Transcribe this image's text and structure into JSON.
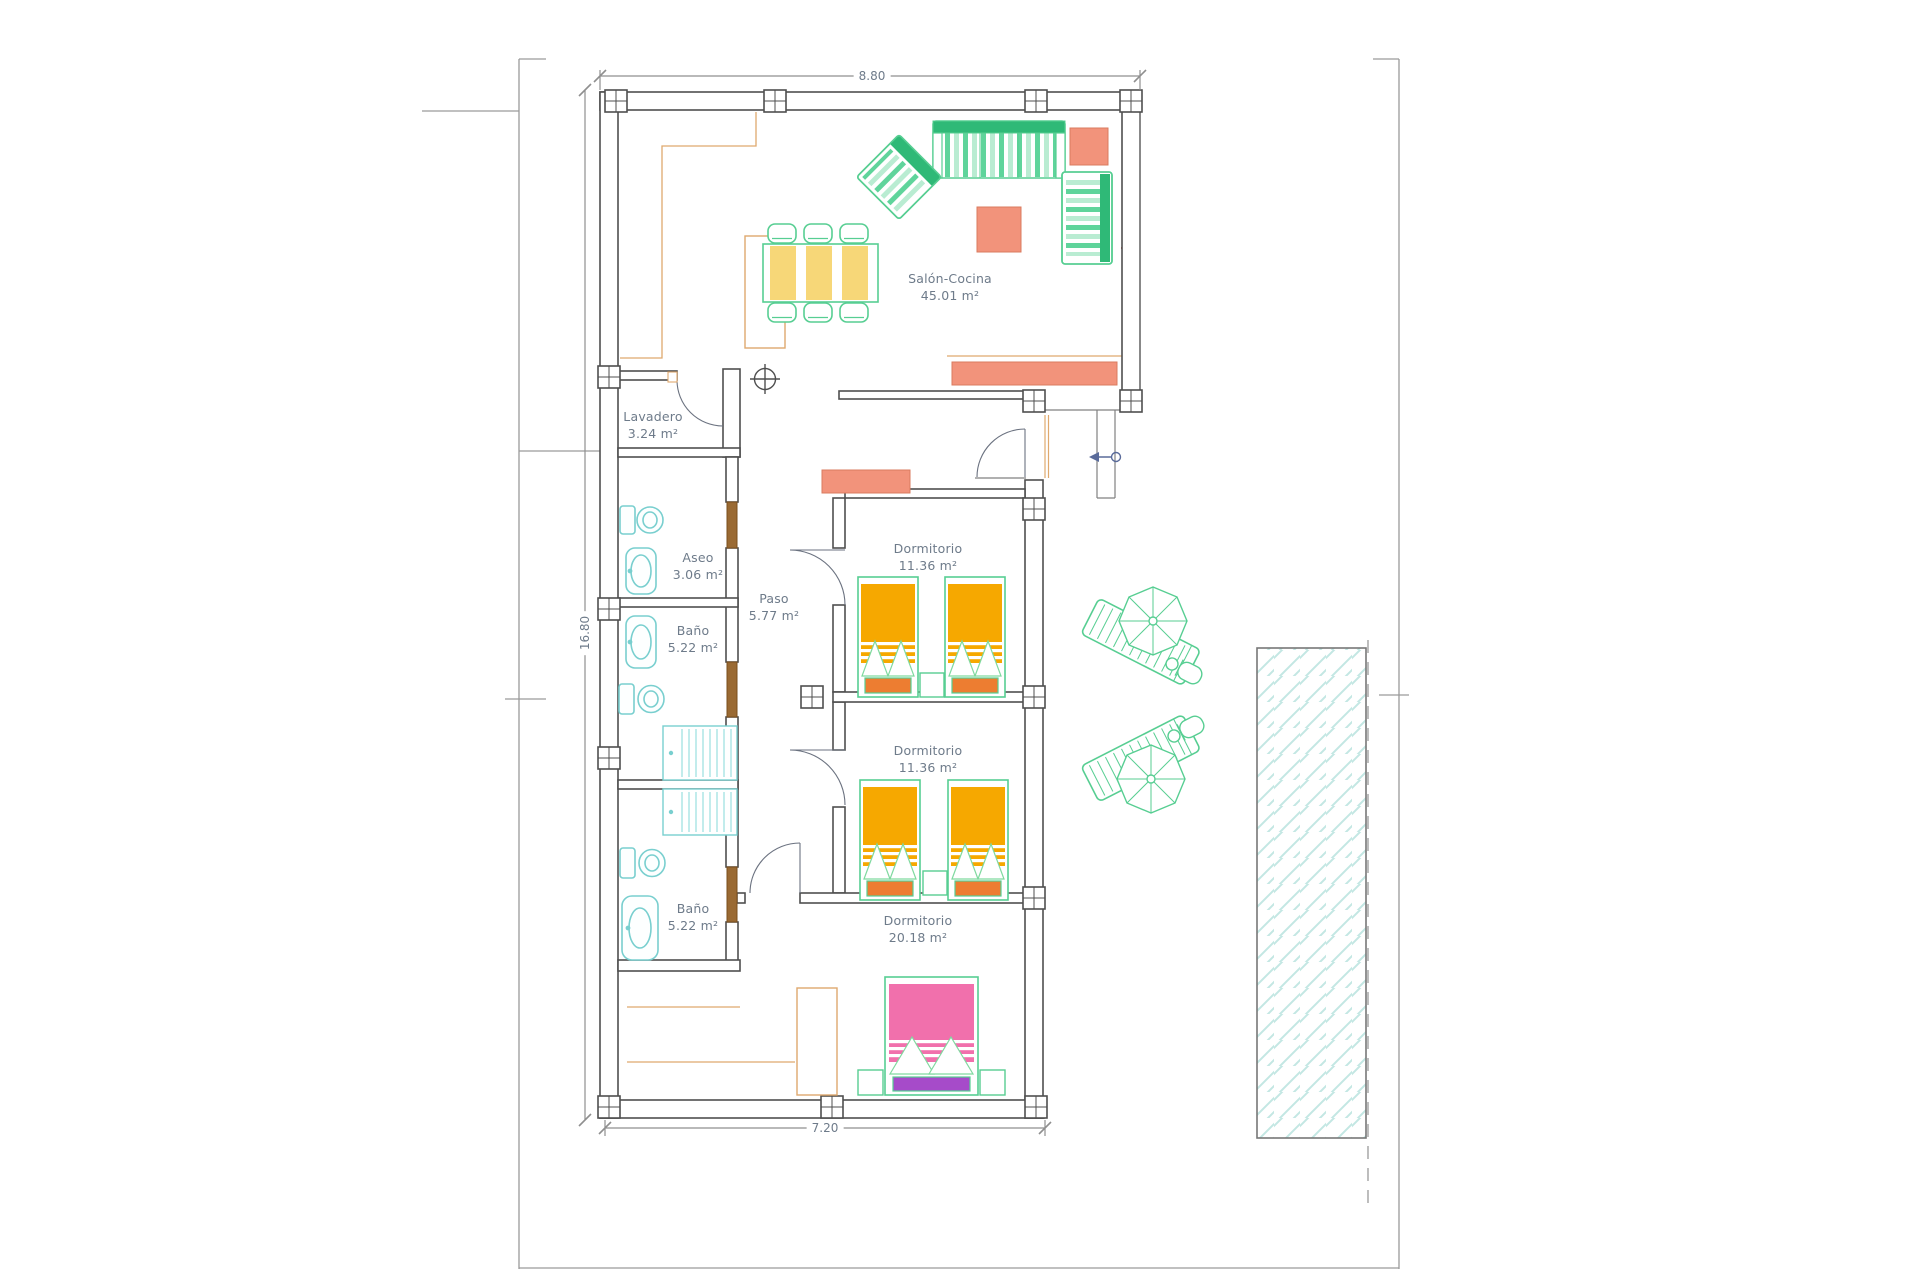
{
  "drawing": {
    "type": "architectural floor plan"
  },
  "dimensions": {
    "top": "8.80",
    "left": "16.80",
    "bottom": "7.20"
  },
  "rooms": [
    {
      "id": "salon-cocina",
      "label": "Salón-Cocina",
      "area": "45.01 m²"
    },
    {
      "id": "lavadero",
      "label": "Lavadero",
      "area": "3.24 m²"
    },
    {
      "id": "aseo",
      "label": "Aseo",
      "area": "3.06 m²"
    },
    {
      "id": "paso",
      "label": "Paso",
      "area": "5.77 m²"
    },
    {
      "id": "bano-1",
      "label": "Baño",
      "area": "5.22 m²"
    },
    {
      "id": "dormitorio-1",
      "label": "Dormitorio",
      "area": "11.36 m²"
    },
    {
      "id": "dormitorio-2",
      "label": "Dormitorio",
      "area": "11.36 m²"
    },
    {
      "id": "bano-2",
      "label": "Baño",
      "area": "5.22 m²"
    },
    {
      "id": "dormitorio-3",
      "label": "Dormitorio",
      "area": "20.18 m²"
    }
  ],
  "colors": {
    "wall": "#4f4f4f",
    "annotation": "#6e7b8a",
    "dimension_line": "#8f8f8f",
    "boundary": "#9a9a9a",
    "green": "#57ce92",
    "dark_green": "#2fb977",
    "mint": "#b9ecd2",
    "salmon": "#f2937b",
    "amber": "#f6a800",
    "orange": "#ed7d31",
    "pink": "#f170ac",
    "purple": "#a64bc9",
    "cyan_fixture": "#79cfcf",
    "pool_hatch": "#c3e7e3",
    "tan": "#dfa96e",
    "window_tick": "#c75450",
    "door_leaf": "#9a6a33"
  }
}
